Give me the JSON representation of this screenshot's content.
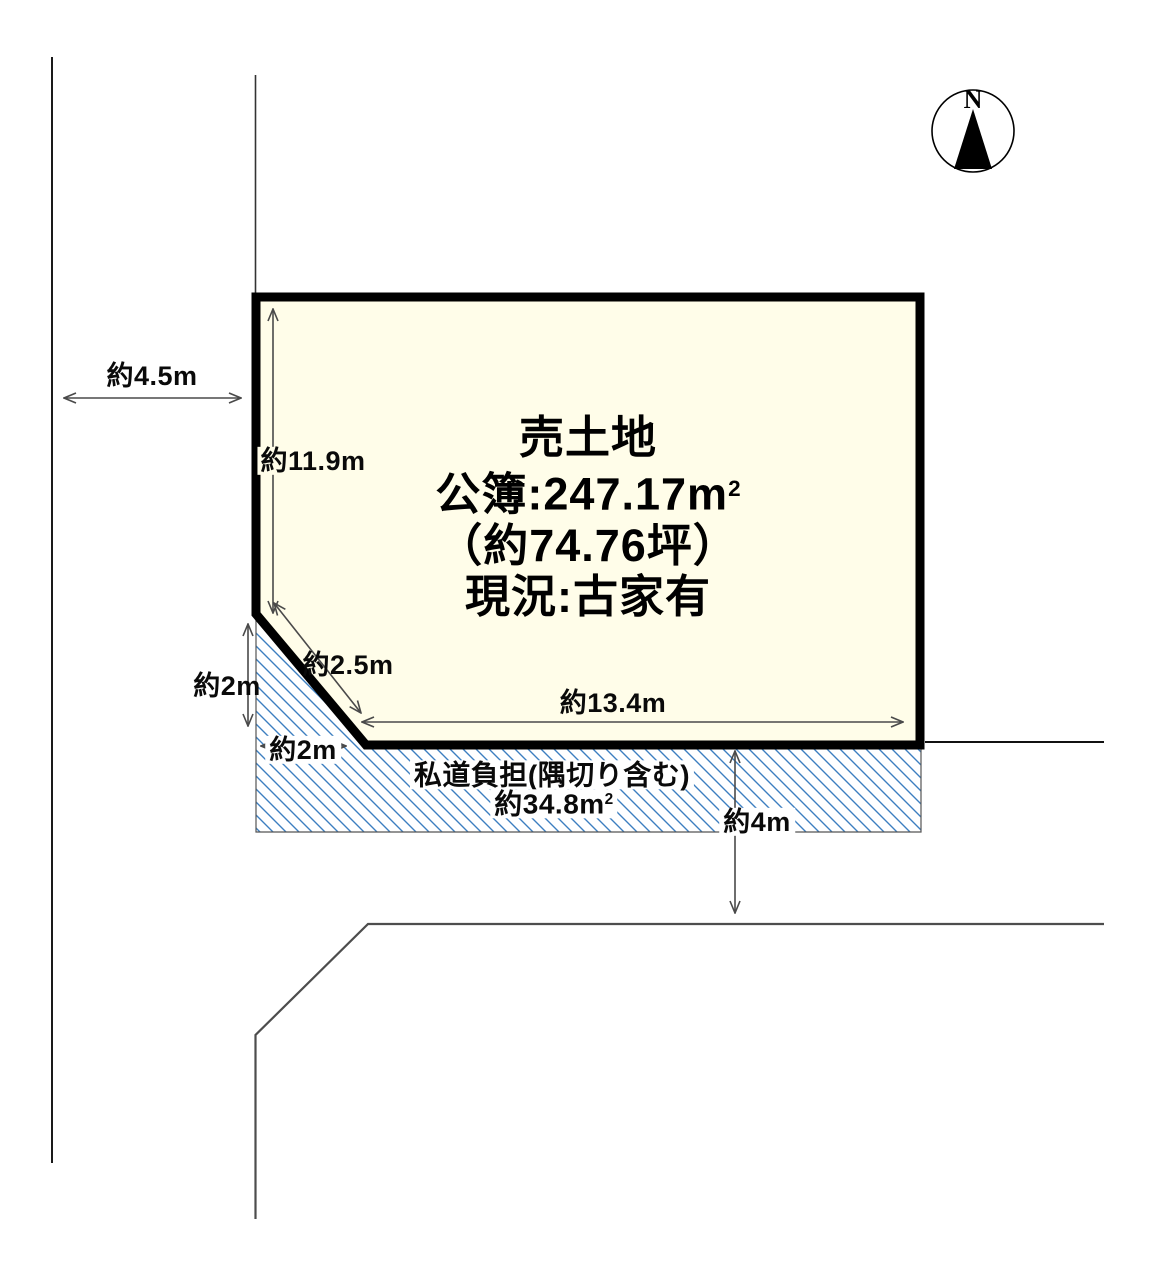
{
  "compass": {
    "label": "N"
  },
  "plot": {
    "line1": "売土地",
    "line2_main": "公簿:247.17m",
    "line2_sup": "2",
    "line3": "（約74.76坪）",
    "line4": "現況:古家有",
    "fill_color": "#fffde9",
    "outline_color": "#000000"
  },
  "dimensions": {
    "west_road_width": "約4.5m",
    "west_boundary": "約11.9m",
    "corner_cut": "約2.5m",
    "corner_vertical": "約2m",
    "corner_horizontal": "約2m",
    "south_boundary": "約13.4m",
    "south_road_width": "約4m"
  },
  "private_road": {
    "label_line1": "私道負担(隅切り含む)",
    "area_main": "約34.8m",
    "area_sup": "2",
    "hatch_color": "#3d7ec0"
  }
}
